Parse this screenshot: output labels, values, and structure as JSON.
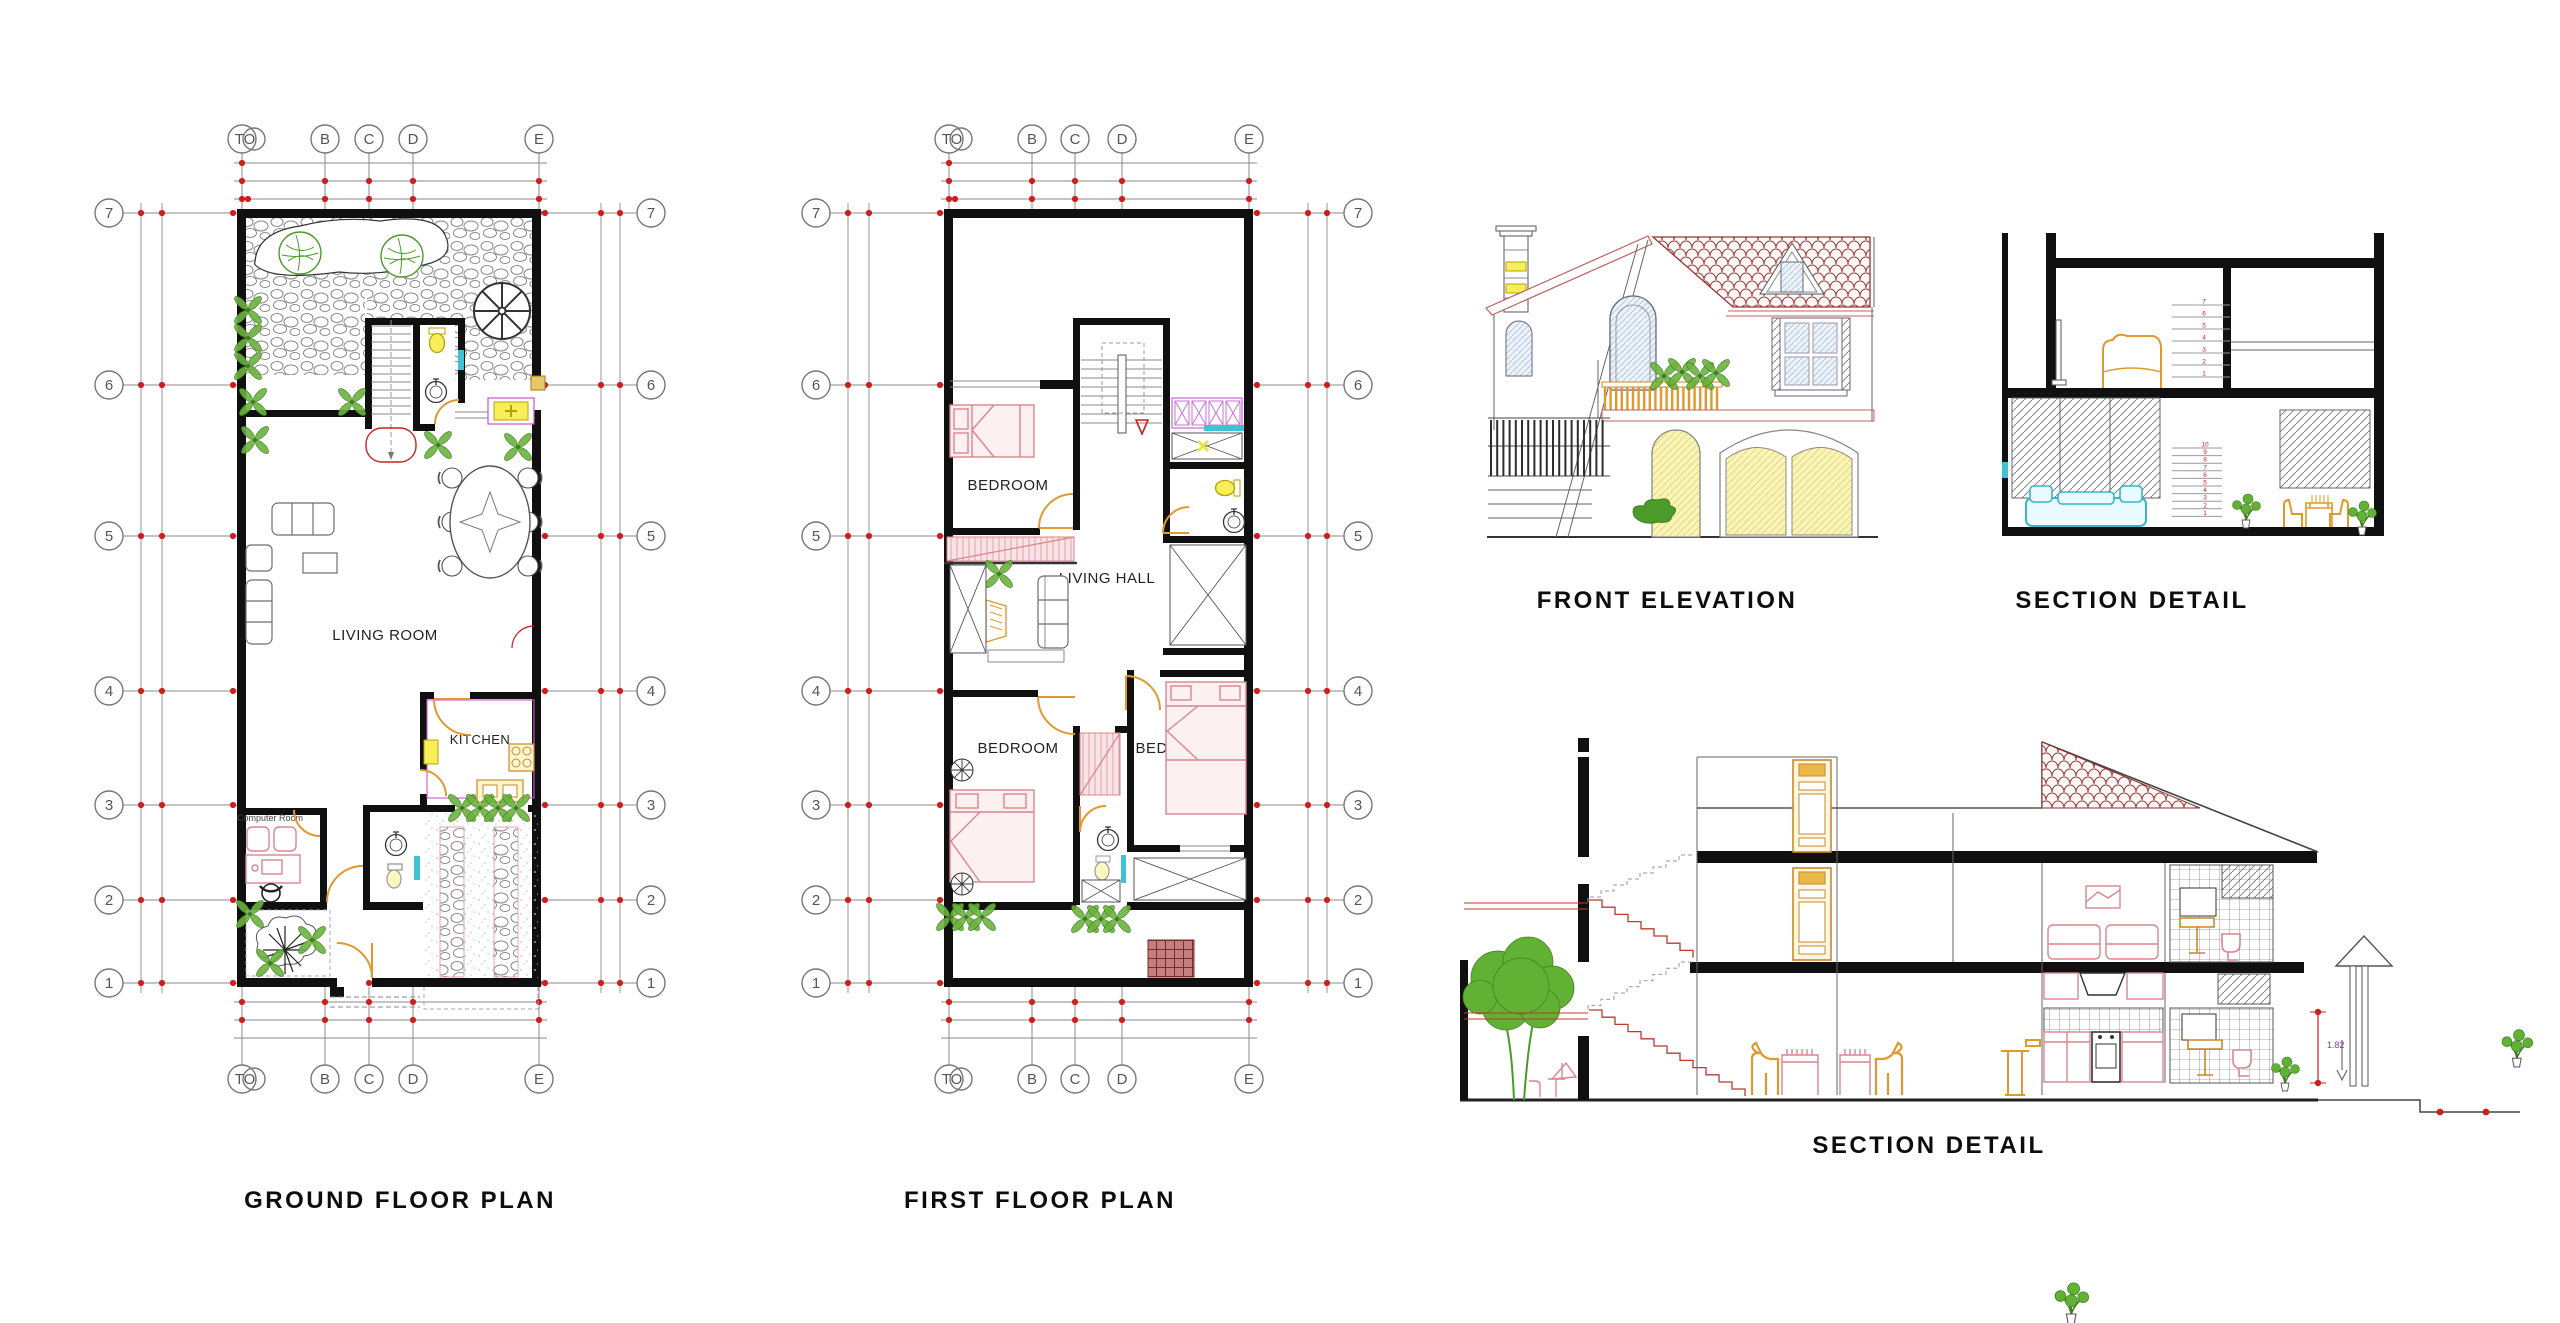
{
  "sheet": {
    "background": "#ffffff"
  },
  "titles": {
    "ground_floor_plan": "GROUND FLOOR PLAN",
    "first_floor_plan": "FIRST FLOOR PLAN",
    "front_elevation": "FRONT ELEVATION",
    "section_detail_top": "SECTION DETAIL",
    "section_detail_bottom": "SECTION DETAIL"
  },
  "grid": {
    "column_labels": [
      "TO",
      "B",
      "C",
      "D",
      "E"
    ],
    "row_labels": [
      "7",
      "6",
      "5",
      "4",
      "3",
      "2",
      "1"
    ]
  },
  "rooms": {
    "ground_floor": {
      "living_room": "LIVING ROOM",
      "kitchen": "KITCHEN",
      "computer_room": "Computer Room"
    },
    "first_floor": {
      "bedroom_top": "BEDROOM",
      "living_hall": "LIVING HALL",
      "bedroom_left": "BEDROOM",
      "bedroom_right": "BEDROOM"
    }
  },
  "annotations": {
    "tank_height_dimension": "1.82",
    "stair_numbers_upper": [
      "1",
      "2",
      "3",
      "4",
      "5",
      "6",
      "7"
    ],
    "stair_numbers_lower": [
      "1",
      "2",
      "3",
      "4",
      "5",
      "6",
      "7",
      "8",
      "9",
      "10"
    ]
  },
  "colors": {
    "wall": "#101010",
    "grid_line": "#8a8a8a",
    "marker_red": "#cc1f1f",
    "furniture_pink": "#d9868e",
    "plant_green": "#4c9a2a",
    "fixture_yellow": "#f2e24a",
    "wood_orange": "#e0992e",
    "glass_cyan": "#3fc3d4",
    "wardrobe_magenta": "#c873d6",
    "roof_tile_red": "#993333",
    "dimension_purple": "#8833cc"
  }
}
